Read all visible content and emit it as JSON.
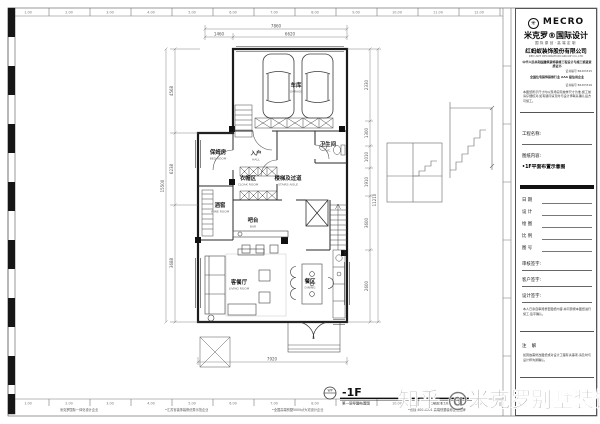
{
  "watermark": "知乎 @米克罗别墅装饰",
  "sheet": {
    "ruler": [
      "1.00",
      "2.00",
      "3.00",
      "4.00",
      "5.00",
      "6.00",
      "7.00",
      "8.00",
      "9.00",
      "10.00",
      "11.00",
      "12.00"
    ],
    "footer_notes": [
      "米克罗国际一体化设计企业",
      "•江苏省装饰装修优秀示范企业",
      "•全国高端别墅5000㎡大宅设计企业",
      "•热线 400-8001 高端别墅装修连锁品牌"
    ]
  },
  "titleblock": {
    "logo": "MECRO",
    "logo_icon": "mecro-seal",
    "brand": "米克罗®国际设计",
    "tagline": "国际原创·高端定制",
    "company": "红蚂蚁装饰股份有限公司",
    "company_sub": "RED ANT DECORATION GROUP CO.,LTD",
    "cert1": "中华人民共和国建筑装饰装修工程设计与施工贰级资质证书",
    "cert1_no": "证书编号 B2203315",
    "cert2": "全国住宅装饰装修行业 AAA 级信用企业",
    "cert2_no": "证书编号 B2203316",
    "notice": "本图纸所示尺寸均以现场实际放样尺寸为准,施工前请仔细核对,如有疑问请及时与设计师联系确认后方可施工。",
    "project_label": "工程名称:",
    "content_label": "图纸内容:",
    "content_value": "•1F平面布置示意图",
    "fields": [
      {
        "label": "日  期"
      },
      {
        "label": "设  计"
      },
      {
        "label": "绘  图"
      },
      {
        "label": "比  例"
      },
      {
        "label": "图  号"
      }
    ],
    "sign1": "审核签字:",
    "sign2": "客户签字:",
    "sign3": "设计签字:",
    "agree": "本人已亲自审阅整套图纸内容,并同意按本图纸进行施工,签字确认。",
    "note_label": "注  解",
    "note": "如因故需修改图纸或对设计工程有关事项,请及时与设计师沟通确认。"
  },
  "plan": {
    "rooms": {
      "garage": {
        "cn": "车库",
        "en": "GARAGE"
      },
      "nanny": {
        "cn": "保姆房",
        "en": "BED ROOM"
      },
      "hall": {
        "cn": "入户",
        "en": "HALL"
      },
      "wc": {
        "cn": "卫生间",
        "en": "WC"
      },
      "cloak": {
        "cn": "衣帽区",
        "en": "CLOAK ROOM"
      },
      "stairhall": {
        "cn": "楼梯及过道",
        "en": "STAIRS AISLE"
      },
      "wine": {
        "cn": "酒窖",
        "en": "WINE ROOM"
      },
      "bar": {
        "cn": "吧台",
        "en": "BAR"
      },
      "living": {
        "cn": "客餐厅",
        "en": "LIVING ROOM"
      },
      "dining": {
        "cn": "餐区",
        "en": "DINING"
      }
    },
    "dims": {
      "top_total": "7860",
      "top_seg1": "1460",
      "top_seg2": "6620",
      "bottom_total": "7920",
      "left_total": "15500",
      "left_seg1": "4568",
      "left_seg2": "6238",
      "left_seg3": "3688",
      "right_total": "11210",
      "right_seg1": "2330",
      "right_seg2": "1300",
      "right_seg3": "1010",
      "right_seg4": "1910",
      "right_seg5": "3600",
      "right_seg6": "2600"
    }
  },
  "footer": {
    "bubble": "WP",
    "title": "-1F",
    "subtitle": "第一层平面布置图",
    "scale": "SCALE 1:100"
  },
  "colors": {
    "line": "#1b1b1b",
    "dim": "#555555",
    "watermark": "#7a7a7a"
  }
}
